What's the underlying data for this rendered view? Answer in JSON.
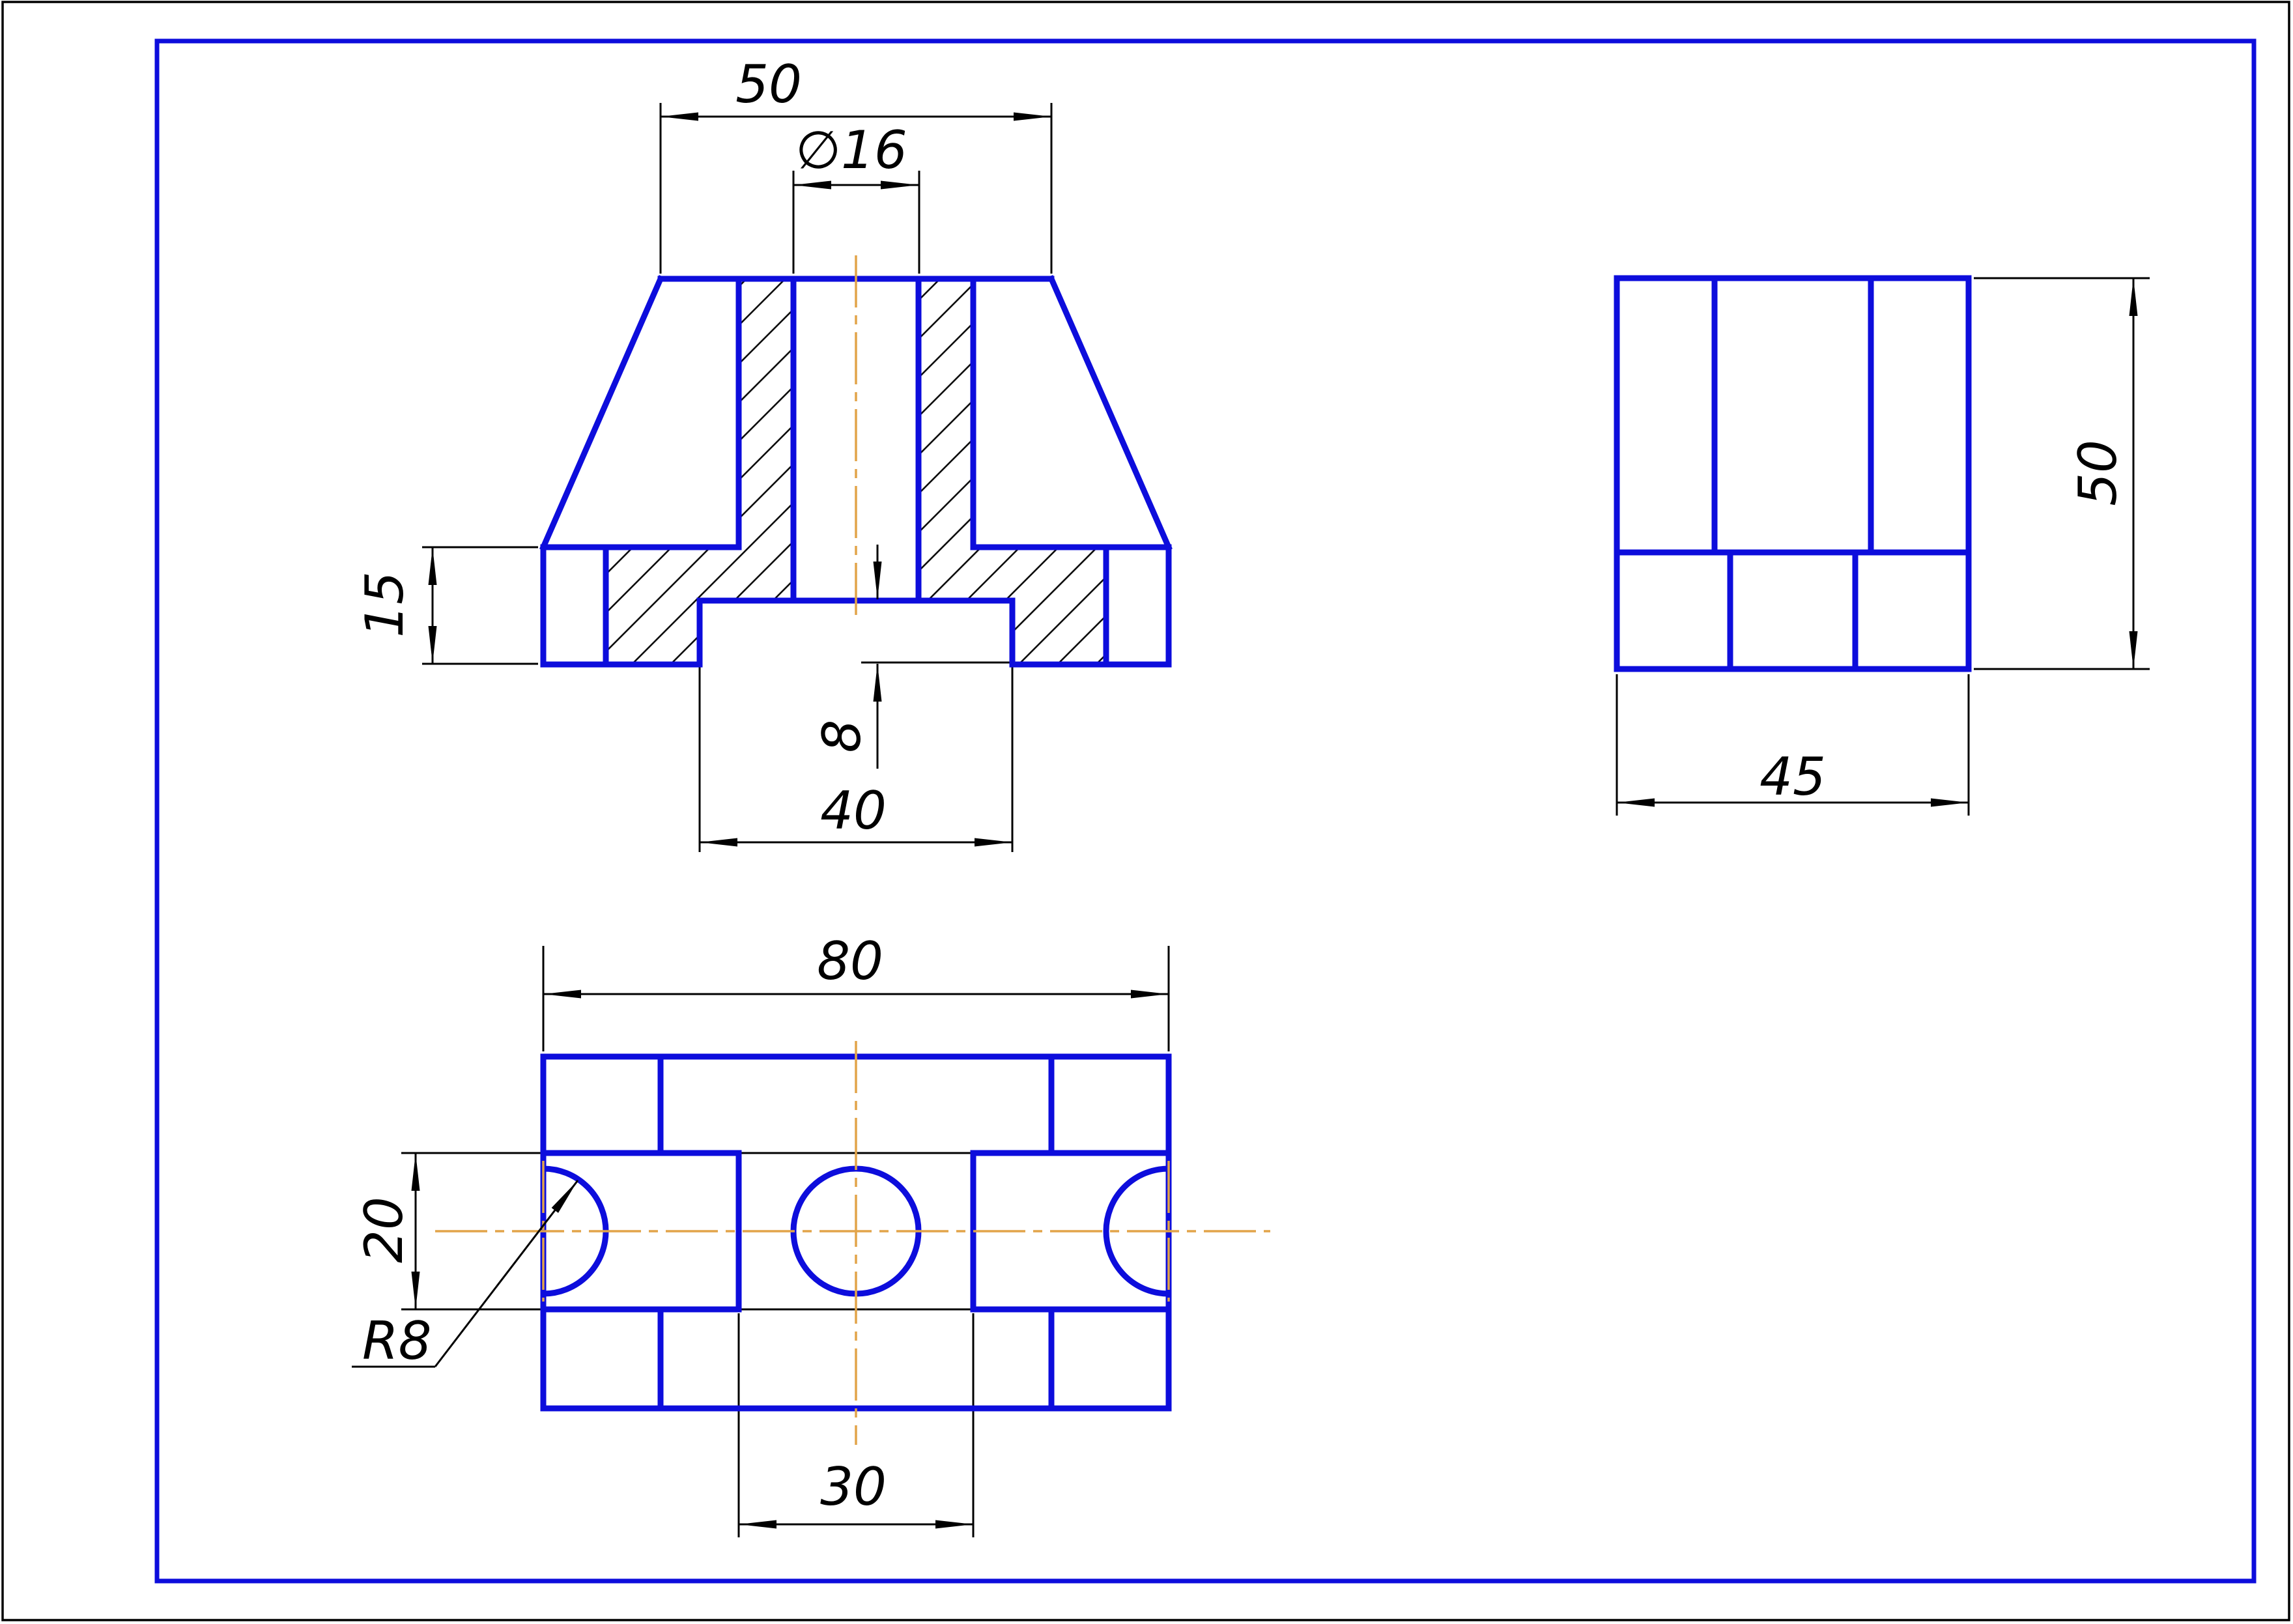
{
  "drawing": {
    "type": "engineering-drawing",
    "colors": {
      "outline_blue": "#0d0ddc",
      "centerline_orange": "#e2a449",
      "dimension_black": "#000000",
      "background": "#ffffff"
    },
    "views": {
      "front_section": {
        "label": "front sectional view",
        "dims": {
          "top_width": "50",
          "hole_diameter": "∅16",
          "base_height": "15",
          "slot_height": "8",
          "slot_width": "40"
        }
      },
      "top": {
        "label": "top view",
        "dims": {
          "overall_width": "80",
          "channel_width": "20",
          "fillet_radius": "R8",
          "boss_width": "30"
        }
      },
      "side": {
        "label": "side view",
        "dims": {
          "depth": "45",
          "overall_height": "50"
        }
      }
    }
  }
}
